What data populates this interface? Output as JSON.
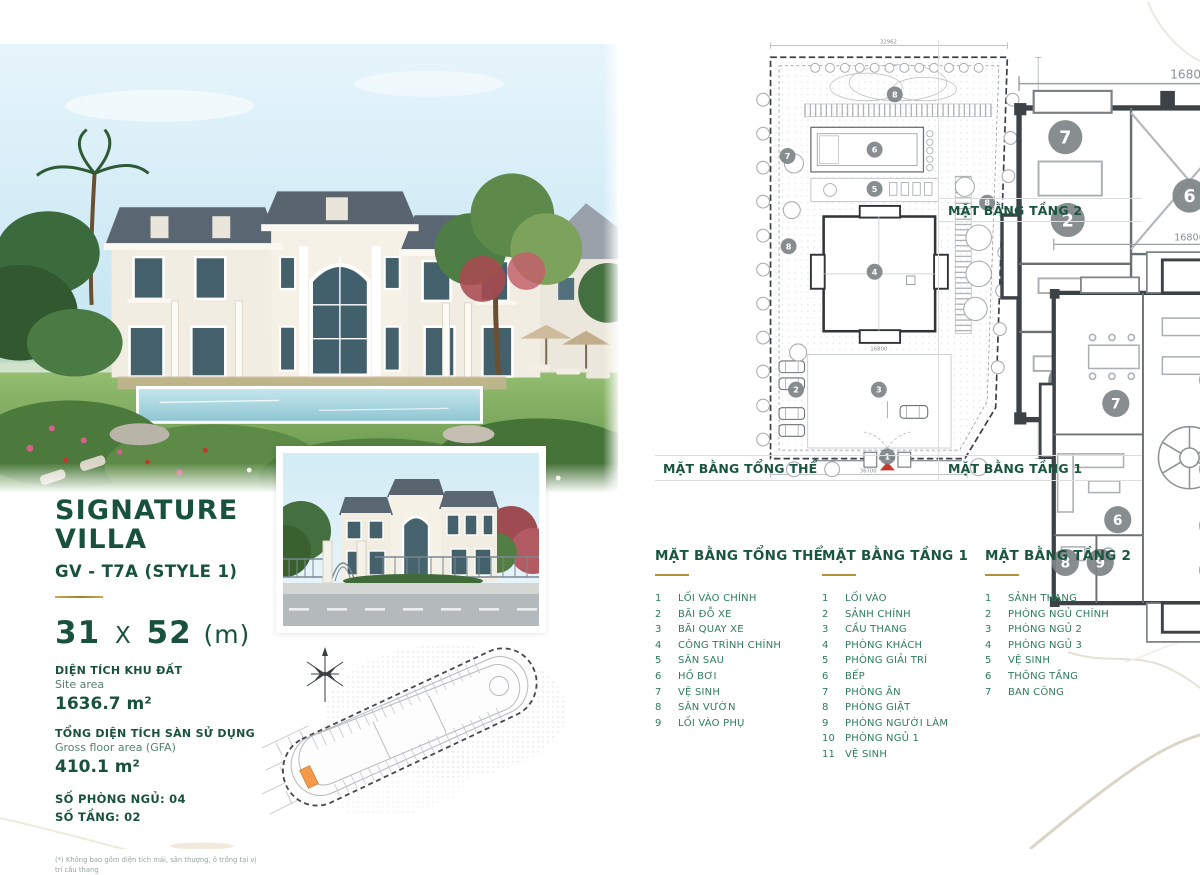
{
  "colors": {
    "green_dark": "#19523c",
    "green_mid": "#2e7c5b",
    "gold": "#b3923c",
    "accent_red": "#c5392f",
    "lot_orange": "#f2994a"
  },
  "info": {
    "title_line1": "SIGNATURE",
    "title_line2": "VILLA",
    "subtitle": "GV - T7A (STYLE 1)",
    "dim_width": "31",
    "dim_sep": "X",
    "dim_length": "52",
    "dim_unit": "(m)",
    "site_area_label_vi": "DIỆN TÍCH KHU ĐẤT",
    "site_area_label_en": "Site area",
    "site_area_value": "1636.7 m²",
    "gfa_label_vi": "TỔNG DIỆN TÍCH SÀN SỬ DỤNG",
    "gfa_label_en": "Gross floor area (GFA)",
    "gfa_value": "410.1 m²",
    "bedrooms_line": "SỐ PHÒNG NGỦ: 04",
    "floors_line": "SỐ TẦNG: 02",
    "footnote": "(*) Không bao gồm diện tích mái, sân thượng, ô trồng tại vị trí cầu thang"
  },
  "plans": {
    "site": {
      "caption": "MẶT BẰNG TỔNG THỂ",
      "dim_top": "32962",
      "dim_bottom": "36700",
      "dim_right": "52000",
      "dim_building": "16800",
      "bubbles": [
        {
          "n": "8",
          "x": 137,
          "y": 55
        },
        {
          "n": "9",
          "x": 267,
          "y": 88
        },
        {
          "n": "7",
          "x": 36,
          "y": 113
        },
        {
          "n": "6",
          "x": 118,
          "y": 107
        },
        {
          "n": "5",
          "x": 118,
          "y": 144
        },
        {
          "n": "8",
          "x": 224,
          "y": 157
        },
        {
          "n": "8",
          "x": 37,
          "y": 198
        },
        {
          "n": "4",
          "x": 118,
          "y": 222
        },
        {
          "n": "2",
          "x": 44,
          "y": 333
        },
        {
          "n": "3",
          "x": 122,
          "y": 333
        },
        {
          "n": "1",
          "x": 130,
          "y": 396
        }
      ]
    },
    "floor2": {
      "caption": "MẶT BẰNG TẦNG 2",
      "dim_top": "16800",
      "bubbles": [
        {
          "n": "7",
          "x": 49,
          "y": 30
        },
        {
          "n": "7",
          "x": 152,
          "y": 30
        },
        {
          "n": "2",
          "x": 50,
          "y": 64
        },
        {
          "n": "6",
          "x": 100,
          "y": 54
        },
        {
          "n": "3",
          "x": 150,
          "y": 66
        },
        {
          "n": "5",
          "x": 170,
          "y": 80
        },
        {
          "n": "5",
          "x": 170,
          "y": 102
        },
        {
          "n": "4",
          "x": 150,
          "y": 106
        },
        {
          "n": "1",
          "x": 100,
          "y": 122
        },
        {
          "n": "5",
          "x": 49,
          "y": 130
        }
      ]
    },
    "floor1": {
      "caption": "MẶT BẰNG TẦNG 1",
      "dim_top": "16800",
      "dim_right": "13700",
      "bubbles": [
        {
          "n": "7",
          "x": 62,
          "y": 92
        },
        {
          "n": "4",
          "x": 112,
          "y": 80
        },
        {
          "n": "5",
          "x": 163,
          "y": 98
        },
        {
          "n": "3",
          "x": 112,
          "y": 126
        },
        {
          "n": "11",
          "x": 144,
          "y": 130
        },
        {
          "n": "11",
          "x": 176,
          "y": 124
        },
        {
          "n": "10",
          "x": 165,
          "y": 146
        },
        {
          "n": "6",
          "x": 63,
          "y": 152
        },
        {
          "n": "2",
          "x": 112,
          "y": 155
        },
        {
          "n": "8",
          "x": 36,
          "y": 174
        },
        {
          "n": "9",
          "x": 54,
          "y": 174
        },
        {
          "n": "1",
          "x": 112,
          "y": 178
        }
      ]
    }
  },
  "legends": [
    {
      "title": "MẶT BẰNG TỔNG THỂ",
      "items": [
        {
          "n": "1",
          "label": "LỐI VÀO CHÍNH"
        },
        {
          "n": "2",
          "label": "BÃI ĐỖ XE"
        },
        {
          "n": "3",
          "label": "BÃI QUAY XE"
        },
        {
          "n": "4",
          "label": "CÔNG TRÌNH CHÍNH"
        },
        {
          "n": "5",
          "label": "SÂN SAU"
        },
        {
          "n": "6",
          "label": "HỒ BƠI"
        },
        {
          "n": "7",
          "label": "VỆ SINH"
        },
        {
          "n": "8",
          "label": "SÂN VƯỜN"
        },
        {
          "n": "9",
          "label": "LỐI VÀO PHỤ"
        }
      ]
    },
    {
      "title": "MẶT BẰNG TẦNG 1",
      "items": [
        {
          "n": "1",
          "label": "LỐI VÀO"
        },
        {
          "n": "2",
          "label": "SẢNH CHÍNH"
        },
        {
          "n": "3",
          "label": "CẦU THANG"
        },
        {
          "n": "4",
          "label": "PHÒNG KHÁCH"
        },
        {
          "n": "5",
          "label": "PHÒNG GIẢI TRÍ"
        },
        {
          "n": "6",
          "label": "BẾP"
        },
        {
          "n": "7",
          "label": "PHÒNG ĂN"
        },
        {
          "n": "8",
          "label": "PHÒNG GIẶT"
        },
        {
          "n": "9",
          "label": "PHÒNG NGƯỜI LÀM"
        },
        {
          "n": "10",
          "label": "PHÒNG NGỦ 1"
        },
        {
          "n": "11",
          "label": "VỆ SINH"
        }
      ]
    },
    {
      "title": "MẶT BẰNG TẦNG 2",
      "items": [
        {
          "n": "1",
          "label": "SẢNH THANG"
        },
        {
          "n": "2",
          "label": "PHÒNG NGỦ CHÍNH"
        },
        {
          "n": "3",
          "label": "PHÒNG NGỦ 2"
        },
        {
          "n": "4",
          "label": "PHÒNG NGỦ 3"
        },
        {
          "n": "5",
          "label": "VỆ SINH"
        },
        {
          "n": "6",
          "label": "THÔNG TẦNG"
        },
        {
          "n": "7",
          "label": "BAN CÔNG"
        }
      ]
    }
  ]
}
